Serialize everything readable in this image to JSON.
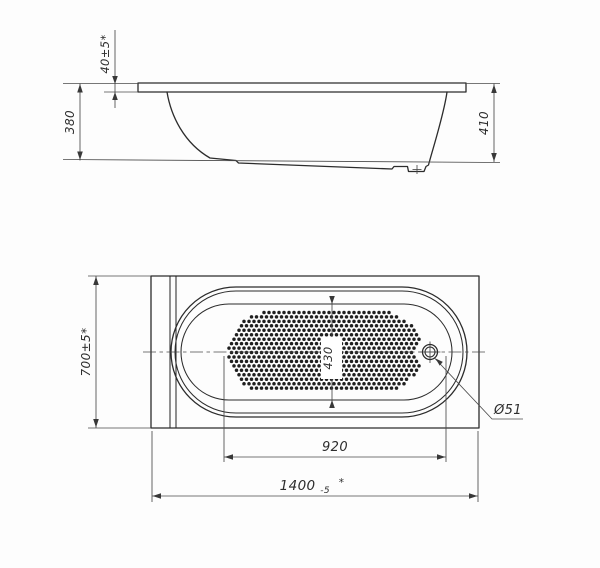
{
  "drawing": {
    "kind": "bathtub technical drawing, side elevation and top plan view"
  },
  "side_view": {
    "rim_height": "40±5*",
    "height_left": "380",
    "height_right": "410"
  },
  "top_view": {
    "overall_width": "700±5*",
    "bottom_length": "920",
    "overall_length": "1400",
    "overall_length_tolerance": "-5",
    "overall_length_note": "*",
    "bottom_width": "430",
    "drain_diameter": "Ø51"
  },
  "colors": {
    "line": "#2c2c2c",
    "dimension_line": "#4a4a4a",
    "background": "#fdfdfd",
    "dots": "#1f1f1f"
  }
}
